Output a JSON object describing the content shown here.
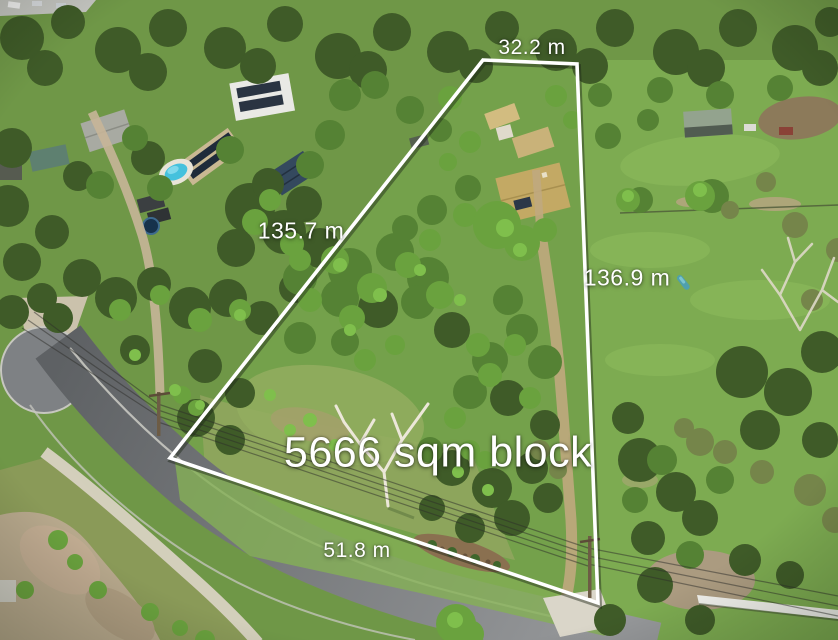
{
  "annotation": {
    "area_label": "5666 sqm block",
    "side_top": "32.2 m",
    "side_left": "135.7 m",
    "side_right": "136.9 m",
    "side_frontage": "51.8 m"
  },
  "colors": {
    "boundary": "#ffffff",
    "label_text": "#ffffff",
    "asphalt_road": "#85888b",
    "paddock_grass": "#7dab51",
    "forest_canopy": "#44582c",
    "pool_water": "#45c1dd",
    "roof_tan": "#c3a964",
    "solar_panel": "#263445",
    "dirt_track": "#c0a87e",
    "concrete_path": "#d8d2c2"
  }
}
